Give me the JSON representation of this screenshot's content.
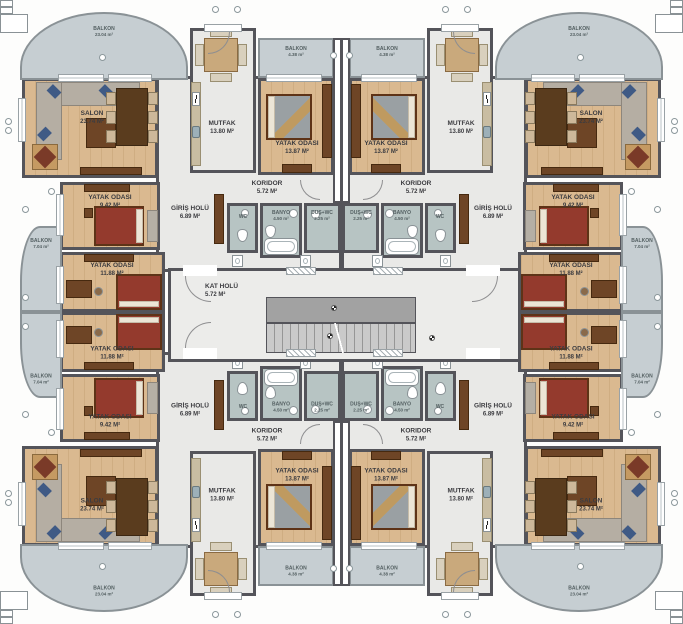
{
  "plan_title": "apartment typical floor plan",
  "rooms": {
    "salon": {
      "name": "SALON",
      "area": "23.74 M²"
    },
    "mutfak": {
      "name": "MUTFAK",
      "area": "13.80 M²"
    },
    "yatak_odasi_1": {
      "name": "YATAK ODASI",
      "area": "13.87 M²"
    },
    "yatak_odasi_2": {
      "name": "YATAK ODASI",
      "area": "9.42 M²"
    },
    "yatak_odasi_3": {
      "name": "YATAK ODASI",
      "area": "11.88 M²"
    },
    "koridor": {
      "name": "KORIDOR",
      "area": "5.72 M²"
    },
    "giris_holu": {
      "name": "GİRİŞ HOLÜ",
      "area": "6.89 M²"
    },
    "kat_holu": {
      "name": "KAT HOLÜ",
      "area": "5.72 M²"
    },
    "wc": {
      "name": "WC",
      "area": ""
    },
    "banyo": {
      "name": "BANYO",
      "area": "4.50 m²"
    },
    "dus_wc": {
      "name": "DUŞ+WC",
      "area": "2.25 m²"
    },
    "balkon_corner": {
      "name": "BALKON",
      "area": "23.04 m²"
    },
    "balkon_side": {
      "name": "BALKON",
      "area": "7.04 m²"
    },
    "balkon_small": {
      "name": "BALKON",
      "area": "4.38 m²"
    }
  },
  "colors": {
    "wall": "#54545a",
    "wood_floor": "#dab990",
    "light_floor": "#e9e9e7",
    "bath_floor": "#b7c4c3",
    "balcony_floor": "#c6ced2",
    "bed_cover_red": "#943a2d",
    "sofa_body": "#b5aea3",
    "sofa_cushion": "#3f5a85",
    "furniture_wood": "#6e4526",
    "stairs": "#cacaca",
    "landing": "#a2a2a2"
  }
}
